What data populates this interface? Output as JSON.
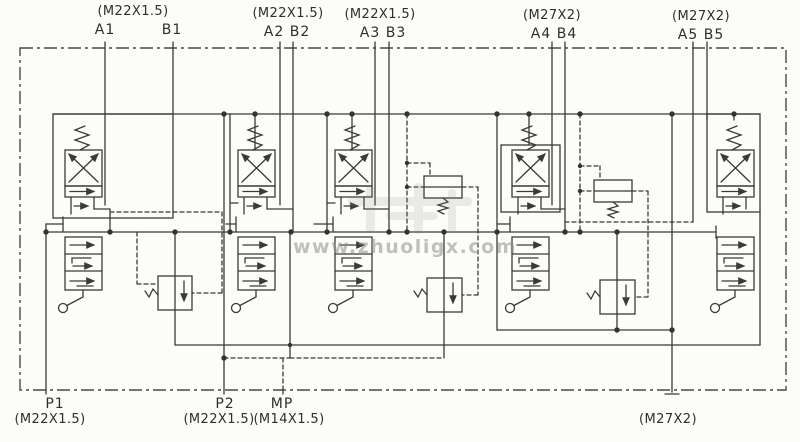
{
  "top_ports": [
    {
      "thread": "(M22X1.5)",
      "a": "A1",
      "b": "B1"
    },
    {
      "thread": "(M22X1.5)",
      "ab": "A2 B2"
    },
    {
      "thread": "(M22X1.5)",
      "ab": "A3 B3"
    },
    {
      "thread": "(M27X2)",
      "ab": "A4 B4"
    },
    {
      "thread": "(M27X2)",
      "ab": "A5 B5"
    }
  ],
  "bottom_ports": [
    {
      "name": "P1",
      "thread": "(M22X1.5)"
    },
    {
      "name": "P2",
      "thread": "(M22X1.5)"
    },
    {
      "name": "MP",
      "thread": "(M14X1.5)"
    },
    {
      "name": "",
      "thread": "(M27X2)"
    }
  ],
  "watermark": {
    "text": "www.zhuoligx.com"
  },
  "colors": {
    "line": "#3a3a3a",
    "paper": "#fcfcf9",
    "watermark_text": "#8f8f8f",
    "label_text": "#2e2e2e"
  }
}
